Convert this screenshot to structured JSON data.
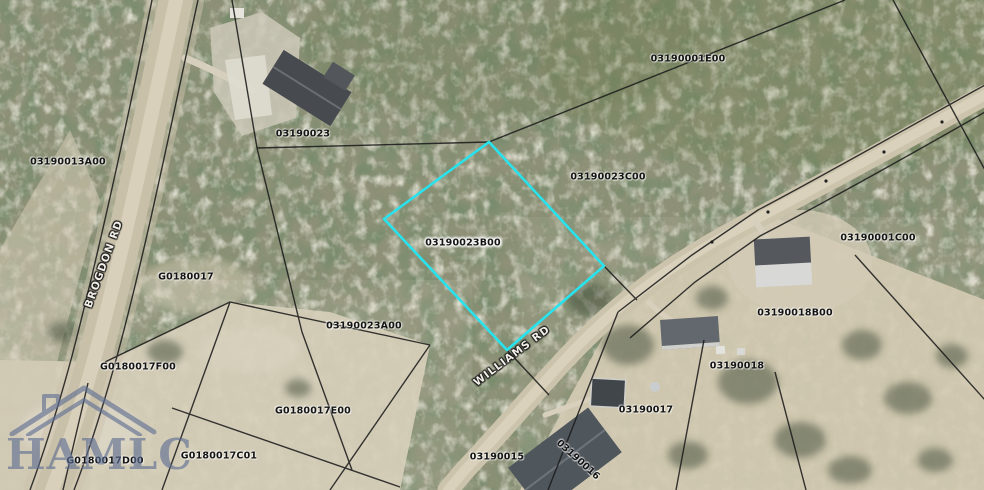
{
  "map": {
    "type": "aerial-parcel-map",
    "highlighted_parcel": "03190023B00",
    "highlight_color": "#27E3EE",
    "parcel_label_color": "#141414",
    "road_label_color": "#F2F0E8",
    "parcel_labels": [
      {
        "text": "03190001E00",
        "x": 688,
        "y": 59
      },
      {
        "text": "03190023",
        "x": 303,
        "y": 134
      },
      {
        "text": "03190013A00",
        "x": 68,
        "y": 162
      },
      {
        "text": "03190023C00",
        "x": 608,
        "y": 177
      },
      {
        "text": "03190001C00",
        "x": 878,
        "y": 238
      },
      {
        "text": "03190023B00",
        "x": 463,
        "y": 243,
        "halo": true
      },
      {
        "text": "G0180017",
        "x": 186,
        "y": 277
      },
      {
        "text": "03190018B00",
        "x": 795,
        "y": 313
      },
      {
        "text": "03190023A00",
        "x": 364,
        "y": 326
      },
      {
        "text": "G0180017F00",
        "x": 138,
        "y": 367
      },
      {
        "text": "03190018",
        "x": 737,
        "y": 366
      },
      {
        "text": "G0180017E00",
        "x": 313,
        "y": 411
      },
      {
        "text": "03190017",
        "x": 646,
        "y": 410
      },
      {
        "text": "G0180017C01",
        "x": 219,
        "y": 456
      },
      {
        "text": "03190015",
        "x": 497,
        "y": 457
      },
      {
        "text": "03190016",
        "x": 578,
        "y": 460,
        "rot": 42
      },
      {
        "text": "G0180017D00",
        "x": 105,
        "y": 461
      }
    ],
    "road_labels": [
      {
        "text": "WILLIAMS RD",
        "x": 512,
        "y": 356,
        "rot": -37
      },
      {
        "text": "BROGDON RD",
        "x": 104,
        "y": 264,
        "rot": -70
      }
    ]
  },
  "watermark": {
    "text": "HAMLC",
    "color": "#5D6D92",
    "icon": "house-roof-icon"
  }
}
